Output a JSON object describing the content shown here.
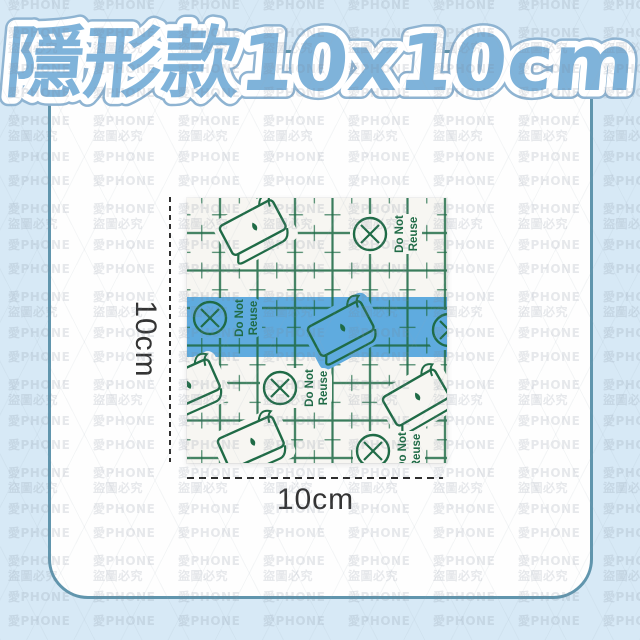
{
  "page": {
    "background_color": "#d7e9f6"
  },
  "title": {
    "text": "隱形款10x10cm",
    "fill_color": "#7fb3da",
    "halo_color": "#ffffff",
    "ring_color": "#8fb4d2"
  },
  "card": {
    "background_color": "#fefefe",
    "border_color": "#6095ad"
  },
  "product": {
    "film": {
      "background_color": "#f7f6f2",
      "grid_color": "#1f6b46",
      "strip_color": "#5fabdf",
      "do_not_reuse": {
        "line1": "Do Not",
        "line2": "Reuse"
      }
    }
  },
  "dimensions": {
    "height_label": "10cm",
    "width_label": "10cm",
    "line_color": "#2e2e2e"
  },
  "watermark": {
    "line1": "愛PHONE",
    "line2": "盜圖必究",
    "color": "rgba(120,135,150,0.18)"
  }
}
